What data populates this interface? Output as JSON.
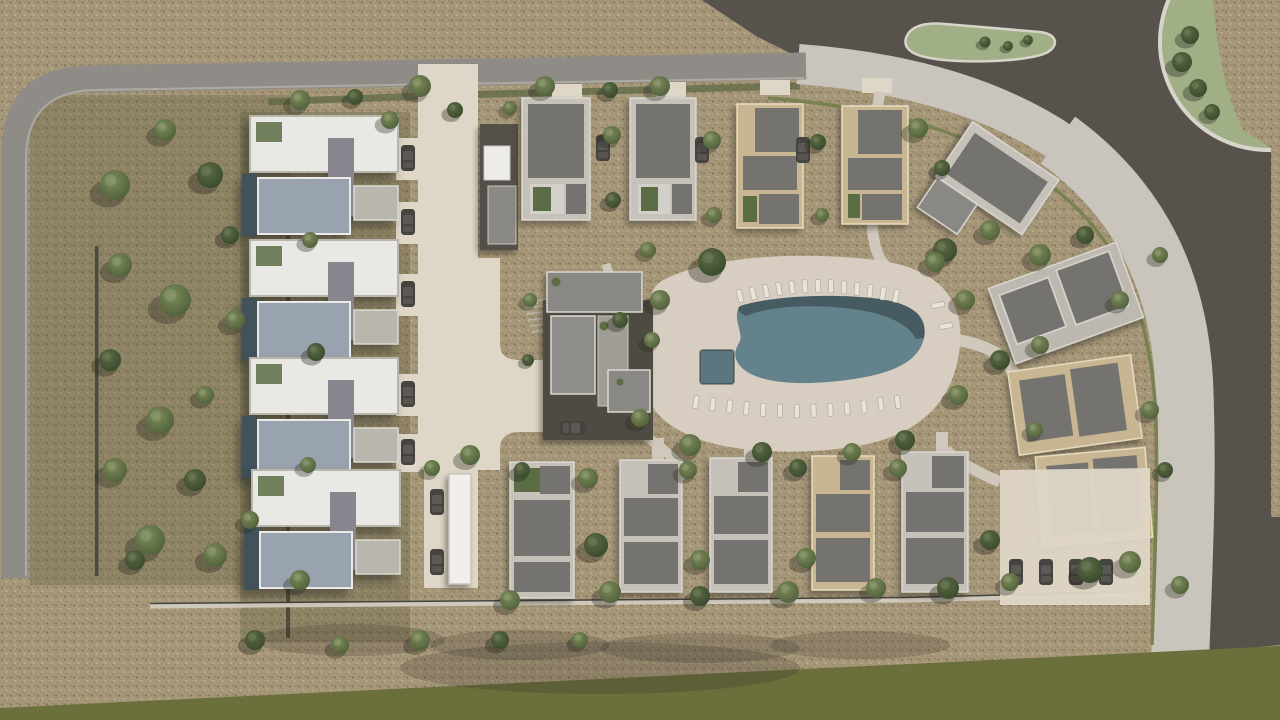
{
  "scene": {
    "type": "3d-aerial-masterplan-render",
    "description": "Top-down 3D architectural rendering of a residential resort community: four apartment blocks on the west, rows of flat-roof villas, a central clubhouse, a free-form swimming pool with sun loungers, internal driveway with parking, a perimeter road, scrub field with trees, and a lake with a small island and green bank at the north-east.",
    "features": [
      "perimeter road",
      "lake",
      "lakeside promenade",
      "triangular island",
      "round green bank",
      "apartment blocks",
      "north villa row",
      "east angled villas",
      "south villa row",
      "clubhouse",
      "free-form pool",
      "kids pool",
      "sun loungers",
      "carport",
      "parking lots",
      "olive field strip",
      "scrub field with trees"
    ],
    "counts": {
      "apartment_blocks": 4,
      "north_villas": 4,
      "east_villas": 4,
      "south_villas": 5,
      "sun_loungers_top": 13,
      "sun_loungers_bottom": 13,
      "sun_loungers_side": 2,
      "cars": 15
    }
  },
  "palette": {
    "terrain": "#a69779",
    "terrain_dot_dark": "#84755c",
    "terrain_dot_light": "#bcae92",
    "terrain_dot_mid": "#93856b",
    "lake_water": "#57524c",
    "road": "#8f8c87",
    "road_edge": "#b9b6b0",
    "promenade": "#c9c5bc",
    "hedge_line": "#7a8150",
    "hedge_dark": "#4b4a3c",
    "driveway": "#ded6c6",
    "deck": "#d7cec1",
    "path_light": "#cfc8bb",
    "pool_water": "#64828b",
    "pool_shadow": "#2e3d42",
    "kiddie_pool": "#5b767e",
    "olive_strip": "#6a6f3c",
    "grass_bank": "#a0af86",
    "bank_rim": "#d8d4ca",
    "roof_white": "#e9e8e4",
    "roof_blue_gray": "#99a3af",
    "roof_gray": "#8a8885",
    "roof_dark": "#75736f",
    "parapet_light": "#c6c2b9",
    "parapet_cream": "#c7b691",
    "courtyard_dark": "#4e4b42",
    "garage_dark": "#535049",
    "canopy_white": "#f0efeb",
    "terrace_pool": "#41525b",
    "car_body": "#454440",
    "car_top": "#5c5a55",
    "lounger": "#e8e4da",
    "patio_green": "#5a6d44",
    "garden_tint": "rgba(70,75,45,0.25)",
    "tree_green_light": "#7e8d5a",
    "tree_green_dark": "#4c5c38",
    "tree_dark_light": "#5d6d45",
    "tree_dark_dark": "#36462b",
    "ground_shadow": "rgba(45,42,35,0.2)"
  }
}
